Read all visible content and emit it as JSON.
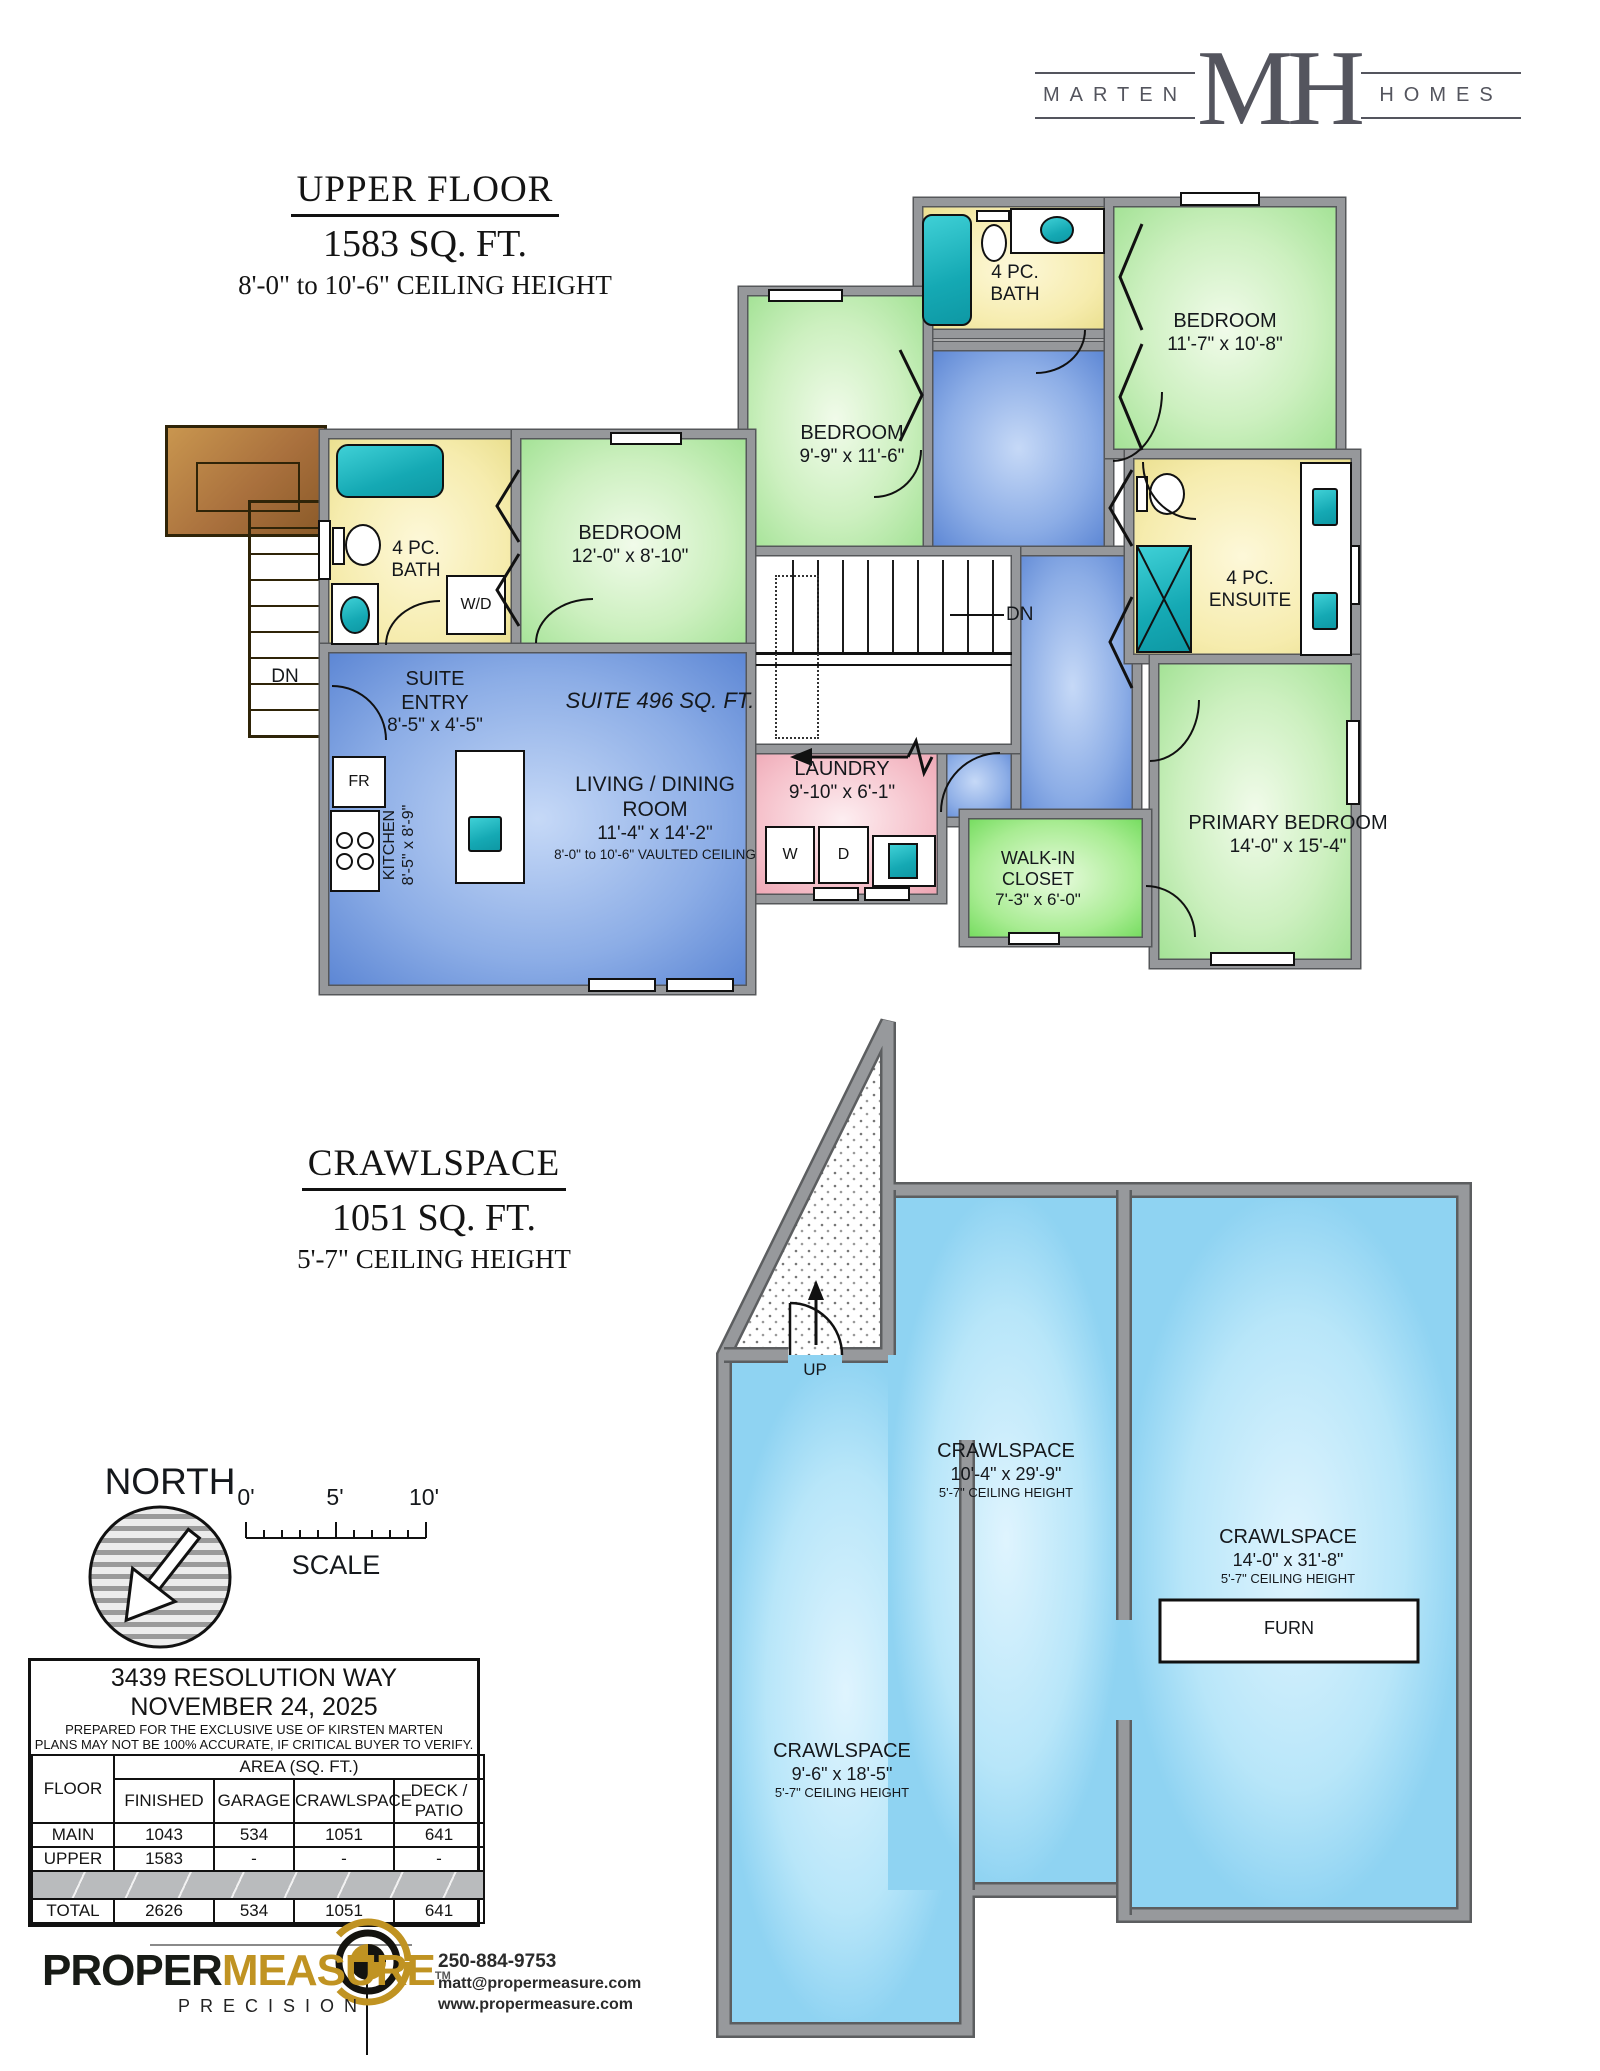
{
  "branding": {
    "left": "MARTEN",
    "monogram": "MH",
    "right": "HOMES",
    "logo_color": "#54555e"
  },
  "upper_header": {
    "title": "UPPER FLOOR",
    "area": "1583 SQ. FT.",
    "ceiling": "8'-0\" to 10'-6\" CEILING HEIGHT"
  },
  "crawl_header": {
    "title": "CRAWLSPACE",
    "area": "1051 SQ. FT.",
    "ceiling": "5'-7\" CEILING HEIGHT"
  },
  "upper": {
    "bath_left": {
      "l1": "4 PC.",
      "l2": "BATH"
    },
    "wd": "W/D",
    "bedroom_left": {
      "l1": "BEDROOM",
      "l2": "12'-0\" x 8'-10\""
    },
    "suite_entry": {
      "l1": "SUITE",
      "l2": "ENTRY",
      "l3": "8'-5\" x 4'-5\""
    },
    "suite_area": "SUITE 496 SQ. FT.",
    "fr": "FR",
    "kitchen": {
      "l1": "KITCHEN",
      "l2": "8'-5\" x 8'-9\""
    },
    "living": {
      "l1": "LIVING / DINING ROOM",
      "l2": "11'-4\" x 14'-2\"",
      "l3": "8'-0\" to 10'-6\" VAULTED CEILING"
    },
    "bedroom_mid": {
      "l1": "BEDROOM",
      "l2": "9'-9\" x 11'-6\""
    },
    "bath_top": {
      "l1": "4 PC.",
      "l2": "BATH"
    },
    "bedroom_tr": {
      "l1": "BEDROOM",
      "l2": "11'-7\" x 10'-8\""
    },
    "ensuite": {
      "l1": "4 PC.",
      "l2": "ENSUITE"
    },
    "primary": {
      "l1": "PRIMARY BEDROOM",
      "l2": "14'-0\" x 15'-4\""
    },
    "wic": {
      "l1": "WALK-IN",
      "l2": "CLOSET",
      "l3": "7'-3\" x 6'-0\""
    },
    "laundry": {
      "l1": "LAUNDRY",
      "l2": "9'-10\" x 6'-1\""
    },
    "w": "W",
    "d": "D",
    "dn_ext": "DN",
    "dn_stairs": "DN"
  },
  "crawl": {
    "mid": {
      "l1": "CRAWLSPACE",
      "l2": "10'-4\" x 29'-9\"",
      "l3": "5'-7\" CEILING HEIGHT"
    },
    "right": {
      "l1": "CRAWLSPACE",
      "l2": "14'-0\" x 31'-8\"",
      "l3": "5'-7\" CEILING HEIGHT"
    },
    "left": {
      "l1": "CRAWLSPACE",
      "l2": "9'-6\" x 18'-5\"",
      "l3": "5'-7\" CEILING HEIGHT"
    },
    "furn": "FURN",
    "up": "UP"
  },
  "north_label": "NORTH",
  "scale_bar": {
    "t0": "0'",
    "t5": "5'",
    "t10": "10'",
    "label": "SCALE"
  },
  "info_table": {
    "address": "3439 RESOLUTION WAY",
    "date": "NOVEMBER 24, 2025",
    "note1": "PREPARED FOR THE EXCLUSIVE USE OF KIRSTEN MARTEN",
    "note2": "PLANS MAY NOT BE 100% ACCURATE, IF CRITICAL BUYER TO VERIFY.",
    "floor_header": "FLOOR",
    "area_header": "AREA (SQ. FT.)",
    "col1": "FINISHED",
    "col2": "GARAGE",
    "col3": "CRAWLSPACE",
    "col4": "DECK / PATIO",
    "rows": [
      {
        "floor": "MAIN",
        "finished": "1043",
        "garage": "534",
        "crawlspace": "1051",
        "deck": "641"
      },
      {
        "floor": "UPPER",
        "finished": "1583",
        "garage": "-",
        "crawlspace": "-",
        "deck": "-"
      }
    ],
    "total": {
      "floor": "TOTAL",
      "finished": "2626",
      "garage": "534",
      "crawlspace": "1051",
      "deck": "641"
    }
  },
  "propermeasure": {
    "brand1": "PROPER",
    "brand2": "MEASURE",
    "tm": "TM",
    "sub": "PRECISION",
    "phone": "250-884-9753",
    "email": "matt@propermeasure.com",
    "web": "www.propermeasure.com"
  },
  "colors": {
    "wall": "#96989b",
    "room_green": "#a3e295",
    "room_yellow": "#eadf8e",
    "room_blue": "#5c86d4",
    "room_pink": "#eda4b2",
    "crawl_blue": "#8fd3f2",
    "fixture_teal": "#15a9b4",
    "deck_brown": "#a9703d",
    "brand_gold": "#c09322",
    "logo_gray": "#54555e"
  }
}
